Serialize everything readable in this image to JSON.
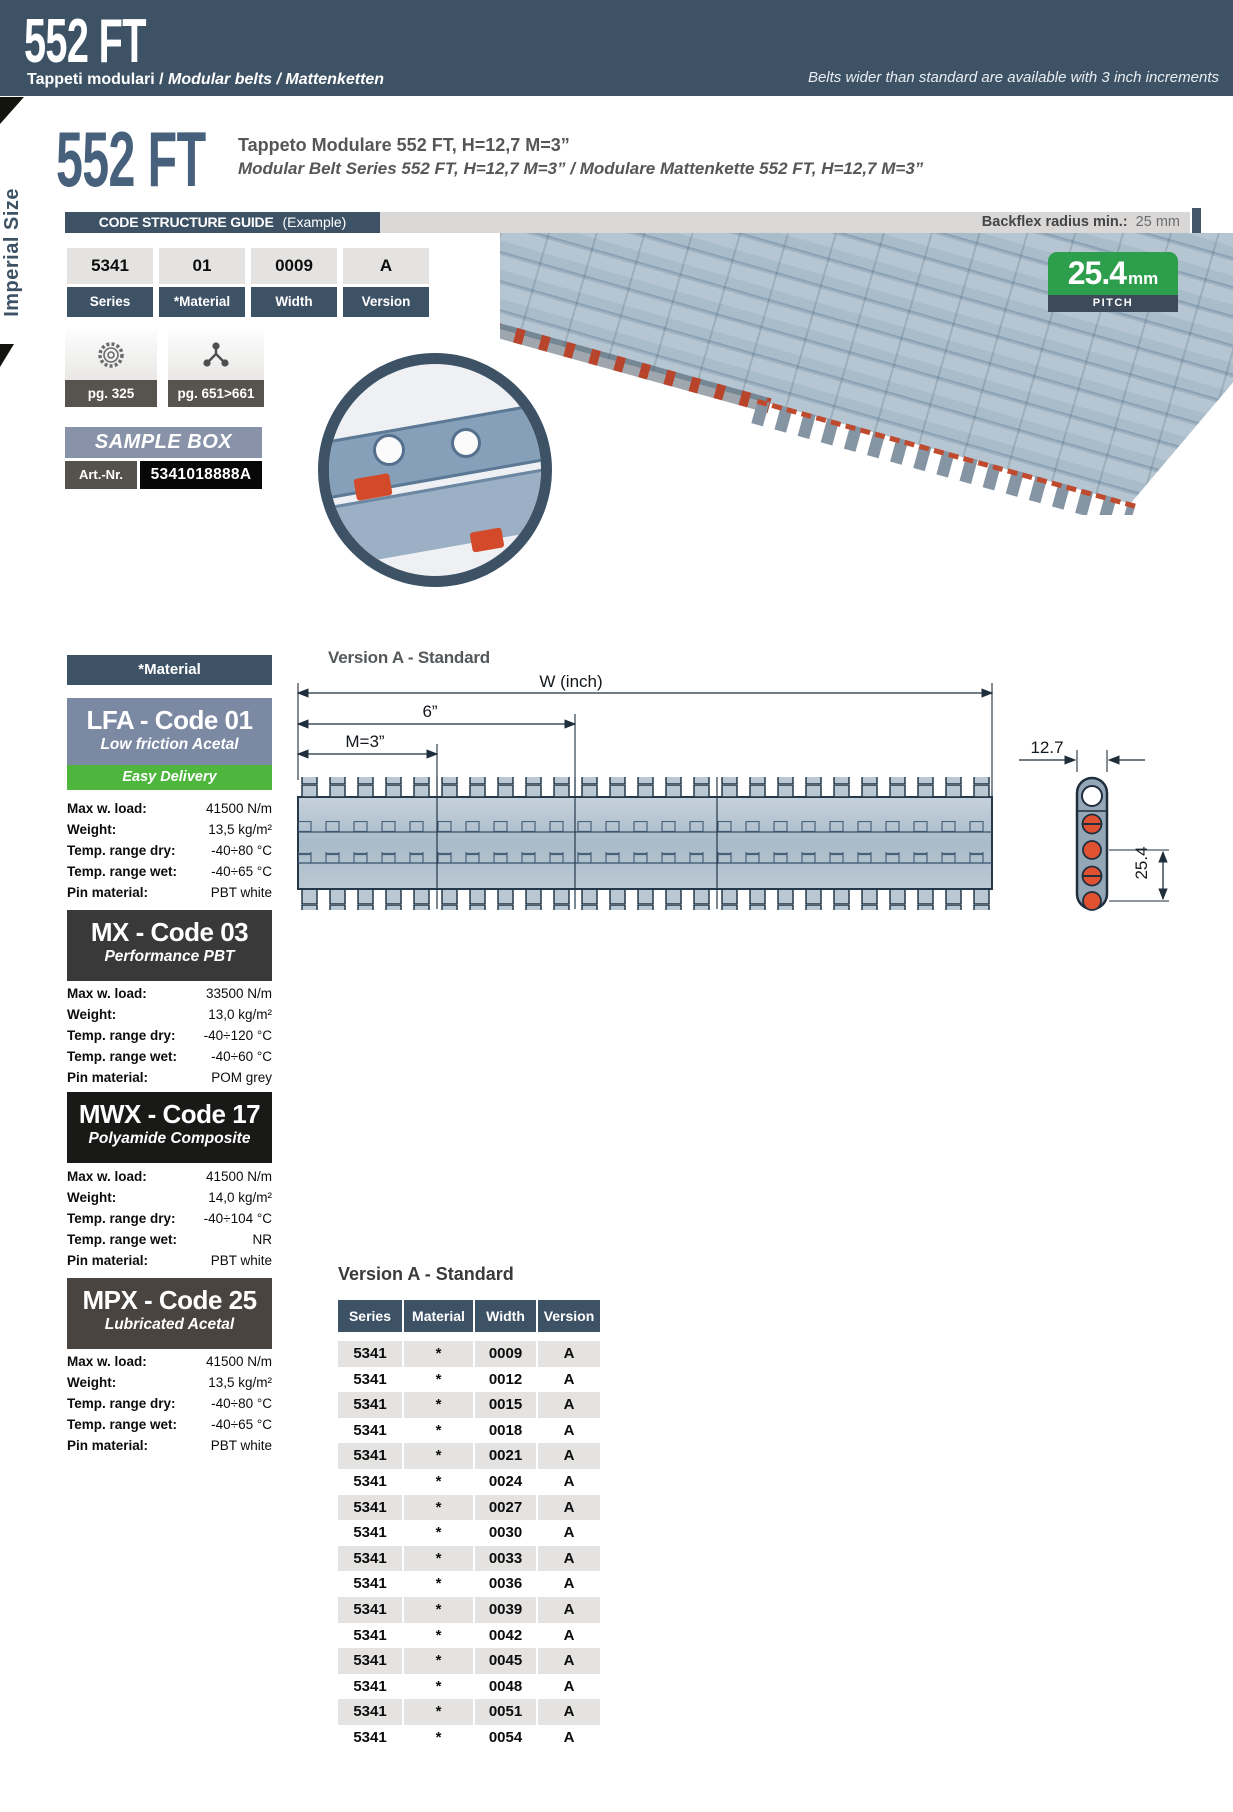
{
  "page": {
    "header": {
      "title": "552 FT",
      "subtitle_plain": "Tappeti modulari / ",
      "subtitle_italic": "Modular belts / Mattenketten",
      "note": "Belts wider than standard are available with 3 inch increments"
    },
    "side_label": "Imperial Size"
  },
  "intro": {
    "title": "552 FT",
    "line1": "Tappeto Modulare 552 FT, H=12,7 M=3”",
    "line2": "Modular Belt Series 552 FT, H=12,7  M=3” / Modulare Mattenkette 552 FT, H=12,7 M=3”"
  },
  "code_guide": {
    "title": "CODE STRUCTURE GUIDE",
    "example": "(Example)",
    "backflex_label": "Backflex radius min.:",
    "backflex_value": "25 mm",
    "cells": [
      {
        "value": "5341",
        "label": "Series"
      },
      {
        "value": "01",
        "label": "*Material"
      },
      {
        "value": "0009",
        "label": "Width"
      },
      {
        "value": "A",
        "label": "Version"
      }
    ]
  },
  "refs": [
    {
      "icon": "gear-icon",
      "label": "pg. 325"
    },
    {
      "icon": "transfer-icon",
      "label": "pg. 651>661"
    }
  ],
  "sample_box": {
    "title": "SAMPLE BOX",
    "art_label": "Art.-Nr.",
    "art_value": "5341018888A"
  },
  "pitch_badge": {
    "value": "25.4",
    "unit": "mm",
    "label": "PITCH"
  },
  "materials": {
    "header": "*Material",
    "items": [
      {
        "code": "LFA - Code 01",
        "name": "Low friction Acetal",
        "tag": "Easy Delivery",
        "specs": [
          [
            "Max w. load:",
            "41500 N/m"
          ],
          [
            "Weight:",
            "13,5 kg/m²"
          ],
          [
            "Temp. range dry:",
            "-40÷80 °C"
          ],
          [
            "Temp. range wet:",
            "-40÷65 °C"
          ],
          [
            "Pin material:",
            "PBT white"
          ]
        ]
      },
      {
        "code": "MX - Code 03",
        "name": "Performance PBT",
        "specs": [
          [
            "Max w. load:",
            "33500 N/m"
          ],
          [
            "Weight:",
            "13,0 kg/m²"
          ],
          [
            "Temp. range dry:",
            "-40÷120 °C"
          ],
          [
            "Temp. range wet:",
            "-40÷60 °C"
          ],
          [
            "Pin material:",
            "POM grey"
          ]
        ]
      },
      {
        "code": "MWX - Code 17",
        "name": "Polyamide Composite",
        "specs": [
          [
            "Max w. load:",
            "41500 N/m"
          ],
          [
            "Weight:",
            "14,0 kg/m²"
          ],
          [
            "Temp. range dry:",
            "-40÷104 °C"
          ],
          [
            "Temp. range wet:",
            "NR"
          ],
          [
            "Pin material:",
            "PBT white"
          ]
        ]
      },
      {
        "code": "MPX - Code 25",
        "name": "Lubricated Acetal",
        "specs": [
          [
            "Max w. load:",
            "41500 N/m"
          ],
          [
            "Weight:",
            "13,5 kg/m²"
          ],
          [
            "Temp. range dry:",
            "-40÷80 °C"
          ],
          [
            "Temp. range wet:",
            "-40÷65 °C"
          ],
          [
            "Pin material:",
            "PBT white"
          ]
        ]
      }
    ]
  },
  "drawing": {
    "heading": "Version A -  Standard",
    "dim_w": "W (inch)",
    "dim_6": "6”",
    "dim_m": "M=3”",
    "dim_127": "12.7",
    "dim_254": "25.4"
  },
  "parts_table": {
    "heading": "Version A - Standard",
    "columns": [
      "Series",
      "Material",
      "Width",
      "Version"
    ],
    "rows": [
      [
        "5341",
        "*",
        "0009",
        "A"
      ],
      [
        "5341",
        "*",
        "0012",
        "A"
      ],
      [
        "5341",
        "*",
        "0015",
        "A"
      ],
      [
        "5341",
        "*",
        "0018",
        "A"
      ],
      [
        "5341",
        "*",
        "0021",
        "A"
      ],
      [
        "5341",
        "*",
        "0024",
        "A"
      ],
      [
        "5341",
        "*",
        "0027",
        "A"
      ],
      [
        "5341",
        "*",
        "0030",
        "A"
      ],
      [
        "5341",
        "*",
        "0033",
        "A"
      ],
      [
        "5341",
        "*",
        "0036",
        "A"
      ],
      [
        "5341",
        "*",
        "0039",
        "A"
      ],
      [
        "5341",
        "*",
        "0042",
        "A"
      ],
      [
        "5341",
        "*",
        "0045",
        "A"
      ],
      [
        "5341",
        "*",
        "0048",
        "A"
      ],
      [
        "5341",
        "*",
        "0051",
        "A"
      ],
      [
        "5341",
        "*",
        "0054",
        "A"
      ]
    ]
  },
  "colors": {
    "header_blue": "#3e5266",
    "badge_green": "#2d9e4b",
    "easy_delivery_green": "#4eb53d",
    "pin_orange": "#df5130",
    "row_gray": "#e4e3e1"
  }
}
